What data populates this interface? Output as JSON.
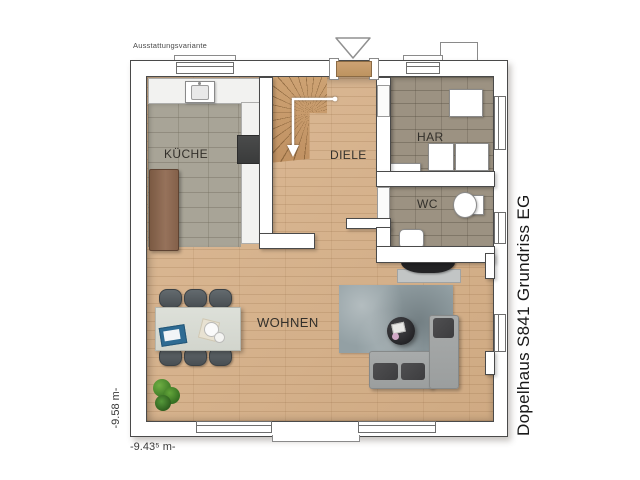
{
  "labels": {
    "variant": "Ausstattungsvariante",
    "title": "Dopelhaus S841 Grundriss EG",
    "dim_left": "-9.58 m-",
    "dim_bottom": "-9.43⁵ m-"
  },
  "rooms": {
    "kueche": {
      "label": "KÜCHE"
    },
    "diele": {
      "label": "DIELE"
    },
    "har": {
      "label": "HAR"
    },
    "wc": {
      "label": "WC"
    },
    "wohnen": {
      "label": "WOHNEN"
    }
  },
  "elements": [
    "entrance-marker-triangle",
    "entrance-door",
    "chimney-block",
    "staircase-with-direction-arrow",
    "kitchen-sink",
    "cooktop",
    "kitchen-counter",
    "kitchen-cabinet",
    "utility-appliances",
    "toilet",
    "washbasin",
    "tv-sideboard",
    "area-rug",
    "coffee-table",
    "corner-sofa",
    "dining-table",
    "dining-chairs",
    "potted-plant",
    "windows",
    "interior-doors"
  ],
  "colors": {
    "wall_outline": "#4a4a4a",
    "wood_floor": "#d9b48d",
    "stair_wood": "#cda273",
    "kitchen_tile": "#a8a497",
    "utility_tile": "#9c9282",
    "counter": "#f2f2f0",
    "cabinet_wood": "#84614a",
    "rug": "#93a0a4",
    "sofa": "#a3a6a6",
    "cushion_dark": "#474749",
    "table_top": "#d9dcd5",
    "chair": "#575d61",
    "accent_dark": "#232325",
    "plant_green": "#4c8a30",
    "tablet_blue": "#2e6b93"
  }
}
